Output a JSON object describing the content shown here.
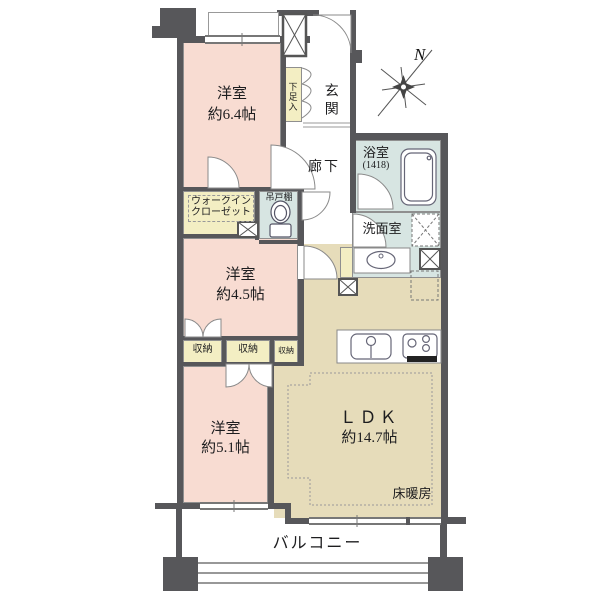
{
  "plan": {
    "compass_north": "N",
    "rooms": {
      "bedroom1": {
        "name": "洋室",
        "size": "約6.4帖"
      },
      "bedroom2": {
        "name": "洋室",
        "size": "約4.5帖"
      },
      "bedroom3": {
        "name": "洋室",
        "size": "約5.1帖"
      },
      "ldk": {
        "name": "ＬＤＫ",
        "size": "約14.7帖",
        "floor_heating": "床暖房"
      },
      "entrance": {
        "label": "玄関",
        "shoe_box": "下足入"
      },
      "hallway": {
        "label": "廊下"
      },
      "bathroom": {
        "label": "浴室",
        "size_code": "(1418)"
      },
      "washroom": {
        "label": "洗面室"
      },
      "toilet": {
        "hanging_shelf": "吊戸棚"
      },
      "walk_in_closet": {
        "line1": "ウォークイン",
        "line2": "クローゼット"
      },
      "storage1": "収納",
      "storage2": "収納",
      "storage3": "収納",
      "balcony": {
        "label": "バルコニー"
      }
    },
    "colors": {
      "room_pink": "#f8dcd2",
      "storage_yellow": "#f3eec3",
      "wet_area_blue": "#d7e5e2",
      "ldk_tan": "#e6dcba",
      "wall_gray": "#57575a"
    }
  }
}
